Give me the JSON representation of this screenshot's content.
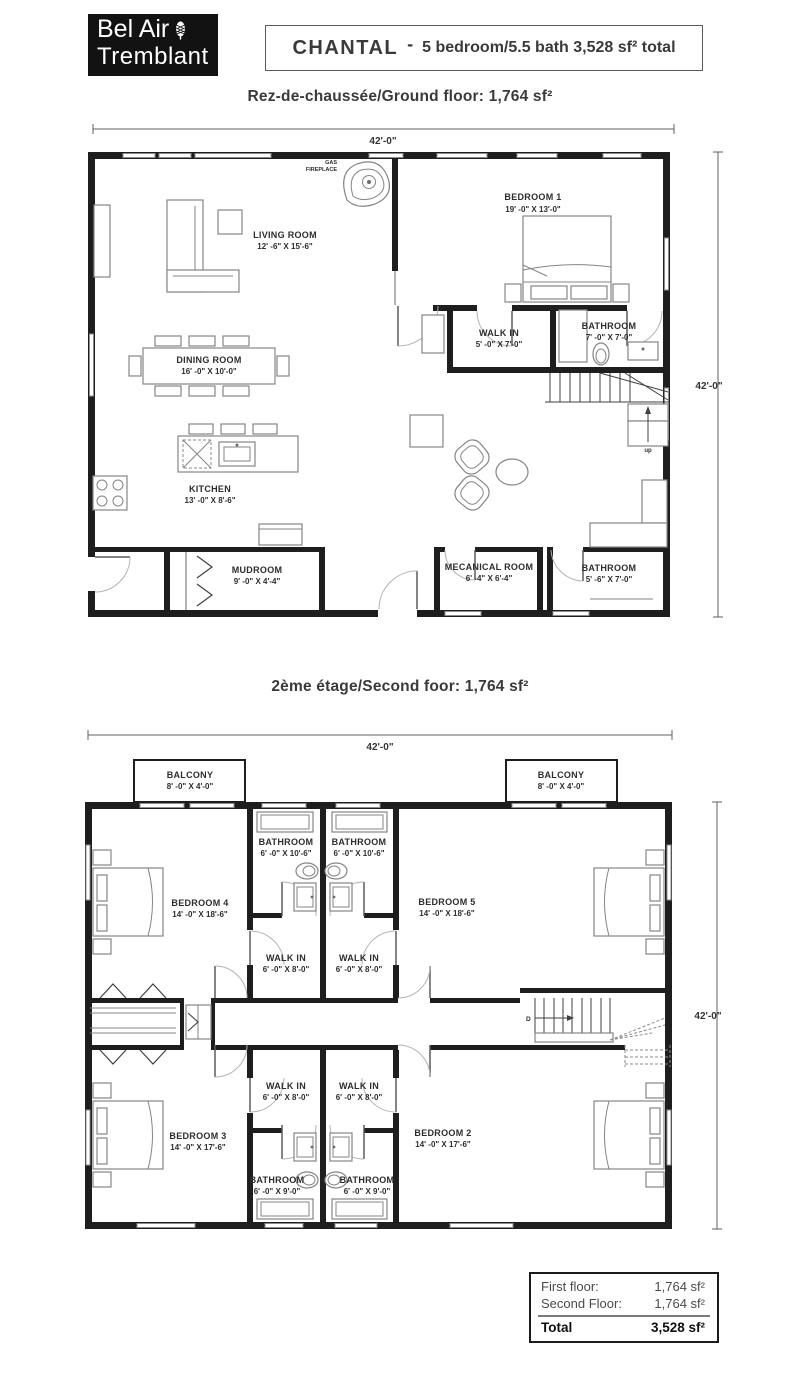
{
  "logo": {
    "line1": "Bel Air",
    "line2": "Tremblant"
  },
  "title": {
    "name": "CHANTAL",
    "dash": "-",
    "rest": "5 bedroom/5.5 bath 3,528 sf² total"
  },
  "floors": {
    "ground": {
      "heading": "Rez-de-chaussée/Ground floor: 1,764 sf²",
      "dim_width": "42'-0\"",
      "dim_height": "42'-0\"",
      "rooms": {
        "living": {
          "name": "LIVING ROOM",
          "dims": "12' -6\" X 15'-6\""
        },
        "bedroom1": {
          "name": "BEDROOM 1",
          "dims": "19' -0\" X 13'-0\""
        },
        "walkin": {
          "name": "WALK IN",
          "dims": "5' -0\" X 7'-0\""
        },
        "bathroom_ensuite": {
          "name": "BATHROOM",
          "dims": "7' -0\" X 7'-0\""
        },
        "dining": {
          "name": "DINING ROOM",
          "dims": "16' -0\" X 10'-0\""
        },
        "kitchen": {
          "name": "KITCHEN",
          "dims": "13' -0\" X 8'-6\""
        },
        "mudroom": {
          "name": "MUDROOM",
          "dims": "9' -0\" X 4'-4\""
        },
        "mechanical": {
          "name": "MECANICAL ROOM",
          "dims": "6' -4\" X 6'-4\""
        },
        "bathroom_main": {
          "name": "BATHROOM",
          "dims": "5' -6\" X 7'-0\""
        }
      },
      "annotations": {
        "fireplace1": "GAS",
        "fireplace2": "FIREPLACE",
        "stairs": "up"
      }
    },
    "second": {
      "heading": "2ème étage/Second foor: 1,764 sf²",
      "dim_width": "42'-0\"",
      "dim_height": "42'-0\"",
      "rooms": {
        "balcony_left": {
          "name": "BALCONY",
          "dims": "8' -0\" X 4'-0\""
        },
        "balcony_right": {
          "name": "BALCONY",
          "dims": "8' -0\" X 4'-0\""
        },
        "bathroom4": {
          "name": "BATHROOM",
          "dims": "6' -0\" X 10'-6\""
        },
        "bathroom5": {
          "name": "BATHROOM",
          "dims": "6' -0\" X 10'-6\""
        },
        "bedroom4": {
          "name": "BEDROOM 4",
          "dims": "14' -0\" X 18'-6\""
        },
        "bedroom5": {
          "name": "BEDROOM 5",
          "dims": "14' -0\" X 18'-6\""
        },
        "walkin4": {
          "name": "WALK IN",
          "dims": "6' -0\" X 8'-0\""
        },
        "walkin5": {
          "name": "WALK IN",
          "dims": "6' -0\" X 8'-0\""
        },
        "walkin3": {
          "name": "WALK IN",
          "dims": "6' -0\" X 8'-0\""
        },
        "walkin2": {
          "name": "WALK IN",
          "dims": "6' -0\" X 8'-0\""
        },
        "bedroom3": {
          "name": "BEDROOM 3",
          "dims": "14' -0\" X 17'-6\""
        },
        "bedroom2": {
          "name": "BEDROOM 2",
          "dims": "14' -0\" X 17'-6\""
        },
        "bathroom3": {
          "name": "BATHROOM",
          "dims": "6' -0\" X 9'-0\""
        },
        "bathroom2": {
          "name": "BATHROOM",
          "dims": "6' -0\" X 9'-0\""
        }
      },
      "annotations": {
        "stairs": "D"
      }
    }
  },
  "summary": {
    "rows": [
      {
        "label": "First floor:",
        "value": "1,764 sf²"
      },
      {
        "label": "Second Floor:",
        "value": "1,764 sf²"
      }
    ],
    "total_label": "Total",
    "total_value": "3,528 sf²"
  },
  "colors": {
    "wall": "#1e1e1e",
    "logo_bg": "#121212",
    "text": "#2d2d2d"
  }
}
